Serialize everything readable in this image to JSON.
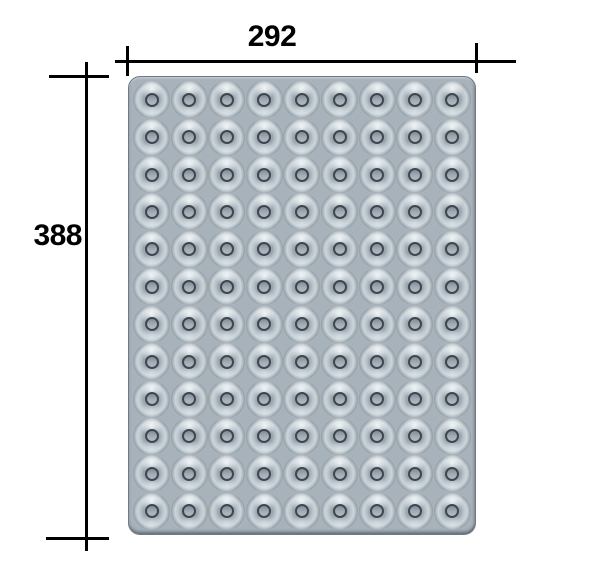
{
  "drawing": {
    "type": "technical-dimension-drawing",
    "subject": "donut-cavity tray (top view)",
    "background_color": "#ffffff",
    "dimensions": {
      "width_label": "292",
      "height_label": "388"
    },
    "tray": {
      "grid": {
        "rows": 12,
        "columns": 9,
        "cavity_count": 108,
        "cavity_shape": "donut"
      },
      "colors": {
        "body": "#a8b2bb",
        "border": "#707a84",
        "cavity_outline": "#39424a",
        "cavity_highlight": "#ccd5da",
        "hole_fill": "#9aa4ad"
      }
    },
    "dimension_style": {
      "line_color": "#000000",
      "line_thickness_px": 3
    }
  }
}
